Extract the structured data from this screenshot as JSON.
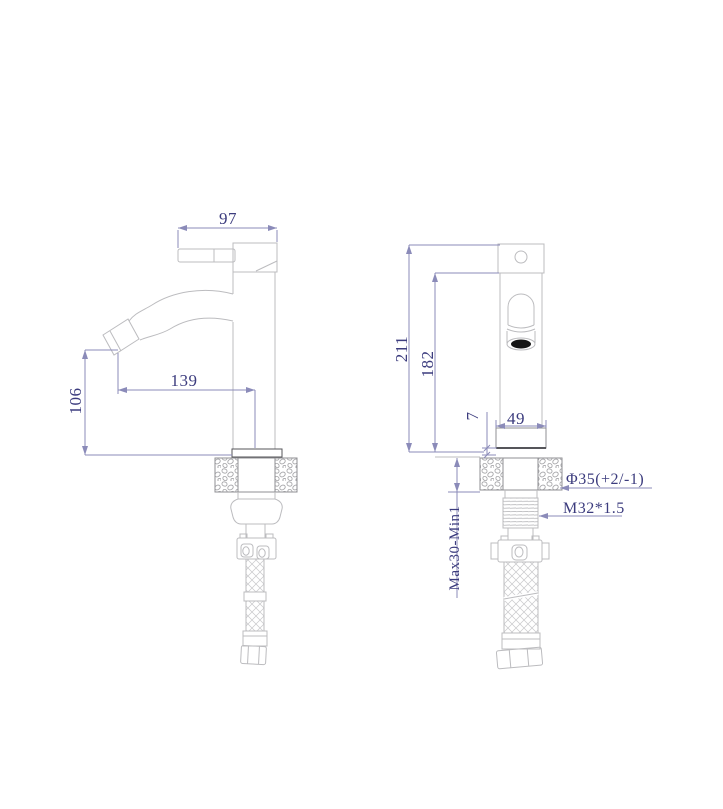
{
  "colors": {
    "background": "#ffffff",
    "geometry": "#bcbcbf",
    "geometry_mid": "#8f8f93",
    "geometry_dark": "#55555a",
    "dimension_line": "#8b8bb9",
    "dimension_text": "#3c3c7e",
    "aerator": "#161616"
  },
  "side_view": {
    "handle_length": "97",
    "spout_reach": "139",
    "spout_height": "106"
  },
  "front_view": {
    "total_height": "211",
    "upper_height": "182",
    "base_width": "49",
    "base_offset": "7",
    "mounting_range": "Max30-Min1",
    "nut_diameter": "Φ35(+2/-1)",
    "thread_spec": "M32*1.5"
  }
}
